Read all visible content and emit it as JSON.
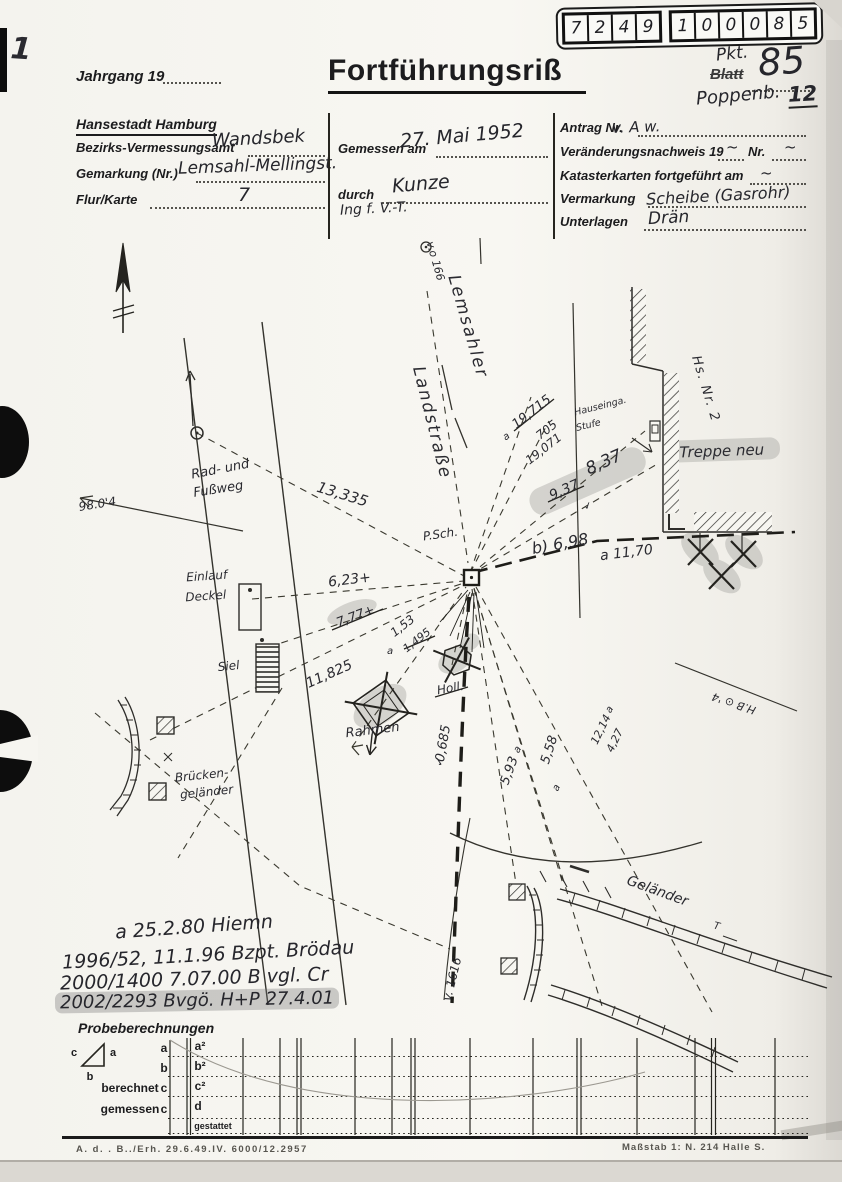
{
  "scan": {
    "corner_mark": "1",
    "footer_left": "A. d. .  B../Erh.  29.6.49.IV.  6000/12.2957",
    "footer_right": "Maßstab 1: N. 214 Halle S."
  },
  "header": {
    "jahrgang_label": "Jahrgang 19",
    "title": "Fortführungsriß"
  },
  "point_grid": {
    "g1": [
      "7",
      "2",
      "4",
      "9"
    ],
    "g2": [
      "1",
      "0",
      "0",
      "0",
      "8",
      "5"
    ]
  },
  "pkt": {
    "pkt_label": "Pkt.",
    "blatt_label": "Blatt",
    "number": "85",
    "district": "Poppenb.",
    "district_number": "12"
  },
  "form": {
    "city": "Hansestadt Hamburg",
    "left": [
      {
        "label": "Bezirks-Vermessungsamt",
        "value": "Wandsbek"
      },
      {
        "label": "Gemarkung (Nr.)",
        "value": "Lemsahl-Mellingst."
      },
      {
        "label": "Flur/Karte",
        "value": "7"
      }
    ],
    "middle": {
      "gemessen_label": "Gemessen am",
      "gemessen_value": "27. Mai 1952",
      "durch_label": "durch",
      "durch_value": "Kunze",
      "durch_value2": "Ing f. V.-T."
    },
    "right": [
      {
        "label": "Antrag Nr.",
        "value": "v. A w."
      },
      {
        "label": "Veränderungsnachweis 19",
        "value": "~",
        "label2": "Nr.",
        "value2": "~"
      },
      {
        "label": "Katasterkarten fortgeführt am",
        "value": "~"
      },
      {
        "label": "Vermarkung",
        "value": "Scheibe (Gasrohr)"
      },
      {
        "label": "Unterlagen",
        "value": "Drän"
      }
    ]
  },
  "sketch": {
    "vo166": "v.o 166",
    "lemsahler": "Lemsahler",
    "landstrasse": "Landstraße",
    "m13335": "13,335",
    "m623": "6,23+",
    "m777": "7,77+",
    "m11825": "11,825",
    "m153": "1,53",
    "m1495": "1,495",
    "a_mark": "a",
    "einlauf1": "Einlauf",
    "einlauf2": "Deckel",
    "siel": "Siel",
    "rad1": "Rad- und",
    "rad2": "Fußweg",
    "m9804": "98.0'4",
    "bruecke1": "Brücken-",
    "bruecke2": "geländer",
    "rahmen": "Rahmen",
    "holl": "Holl.",
    "m0685": "0,685",
    "m593": "5,93",
    "m558": "5,58",
    "m1214": "12,14",
    "m427": "4,27",
    "hb_mark": "H.B ⊙ '4",
    "m937": "9,37",
    "m837": "8,37",
    "b698": "b) 6,98",
    "a1170": "a 11,70",
    "m19715": "19,715",
    "m705": "705",
    "m19071": "19,071",
    "psch": "P.Sch.",
    "hausein1": "Hauseinga.",
    "hausein2": "Stufe",
    "hsnr2": "Hs. Nr. 2",
    "treppe": "Treppe neu",
    "gelaender": "Geländer",
    "v1616": "v. 1616",
    "check": "✓",
    "t_mark": "T"
  },
  "annotations": {
    "line1": "a 25.2.80  Hiemn",
    "line2": "1996/52, 11.1.96  Bzpt. Brödau",
    "line3": "2000/1400  7.07.00   B vgl. Cr",
    "line4": "2002/2293  Bvgö.  H+P  27.4.01"
  },
  "probe": {
    "title": "Probeberechnungen",
    "tri_a": "a",
    "tri_b": "b",
    "tri_c": "c",
    "row_a": "a",
    "row_a2": "a²",
    "row_b": "b",
    "row_b2": "b²",
    "berechnet": "berechnet",
    "row_c": "c",
    "row_c2": "c²",
    "gemessen": "gemessen",
    "row_c2_label": "c",
    "row_d": "d",
    "gestattet": "gestattet"
  }
}
